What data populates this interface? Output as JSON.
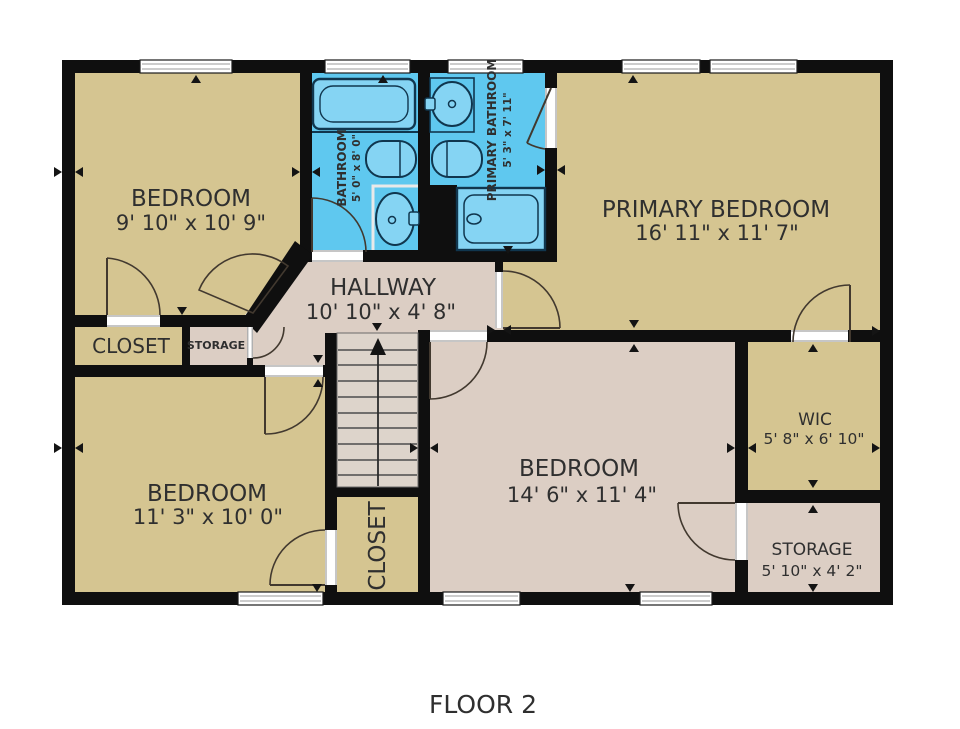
{
  "title": "FLOOR 2",
  "rooms": {
    "bedroom_tl": {
      "name": "BEDROOM",
      "dims": "9' 10\" x 10' 9\""
    },
    "bathroom": {
      "name": "BATHROOM",
      "dims": "5' 0\" x 8' 0\""
    },
    "primary_bathroom": {
      "name": "PRIMARY BATHROOM",
      "dims": "5' 3\" x 7' 11\""
    },
    "primary_bedroom": {
      "name": "PRIMARY BEDROOM",
      "dims": "16' 11\" x 11' 7\""
    },
    "hallway": {
      "name": "HALLWAY",
      "dims": "10' 10\" x 4' 8\""
    },
    "closet_left": {
      "name": "CLOSET"
    },
    "storage_small": {
      "name": "STORAGE"
    },
    "bedroom_bl": {
      "name": "BEDROOM",
      "dims": "11' 3\" x 10' 0\""
    },
    "bedroom_center": {
      "name": "BEDROOM",
      "dims": "14' 6\" x 11' 4\""
    },
    "closet_stairs": {
      "name": "CLOSET"
    },
    "wic": {
      "name": "WIC",
      "dims": "5' 8\" x 6' 10\""
    },
    "storage_br": {
      "name": "STORAGE",
      "dims": "5' 10\" x 4' 2\""
    }
  },
  "fixtures": [
    "bathtub",
    "toilet",
    "sink",
    "shower",
    "stairs-up-arrow"
  ],
  "colors": {
    "wall": "#0f0f0f",
    "room_tan": "#d5c591",
    "room_pink": "#dccec4",
    "stairs": "#ddd4cb",
    "bathroom_blue": "#5fc8ef",
    "fixture_blue": "#85d4f3",
    "fixture_outline": "#10364e",
    "label_text": "#2f2f2f",
    "background": "#ffffff"
  }
}
